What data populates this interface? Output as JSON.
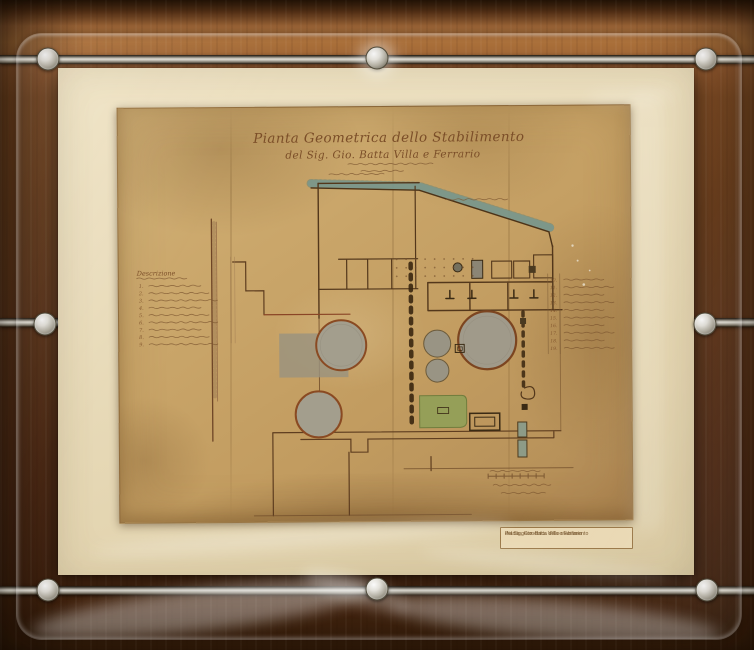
{
  "palette": {
    "wood_light": "#b5783f",
    "wood_dark": "#45250f",
    "mat_cream": "#e9dcbb",
    "paper_tan": "#c9a569",
    "ink_sepia": "#5e3d1f",
    "water_band": "#95afa3",
    "tank_gray": "#a39e8d",
    "rust_ring": "#8a4a22",
    "green_area": "#93a058",
    "metal_rail": "#d9d5ca"
  },
  "artwork": {
    "title_line1": "Pianta Geometrica dello Stabilimento",
    "title_line2": "del Sig. Gio. Batta Villa e Ferrario",
    "legend_left": {
      "header": "Descrizione",
      "numbers": [
        "1.",
        "2.",
        "3.",
        "4.",
        "5.",
        "6.",
        "7.",
        "8.",
        "9."
      ]
    },
    "legend_right": {
      "numbers": [
        "10.",
        "11.",
        "12.",
        "13.",
        "14.",
        "15.",
        "16.",
        "17.",
        "18.",
        "19."
      ]
    }
  },
  "caption_label": {
    "line1": "Pianta geometrica dello stabilimento",
    "line2": "del Sig. Gio. Batta Villa e Ferrario"
  }
}
